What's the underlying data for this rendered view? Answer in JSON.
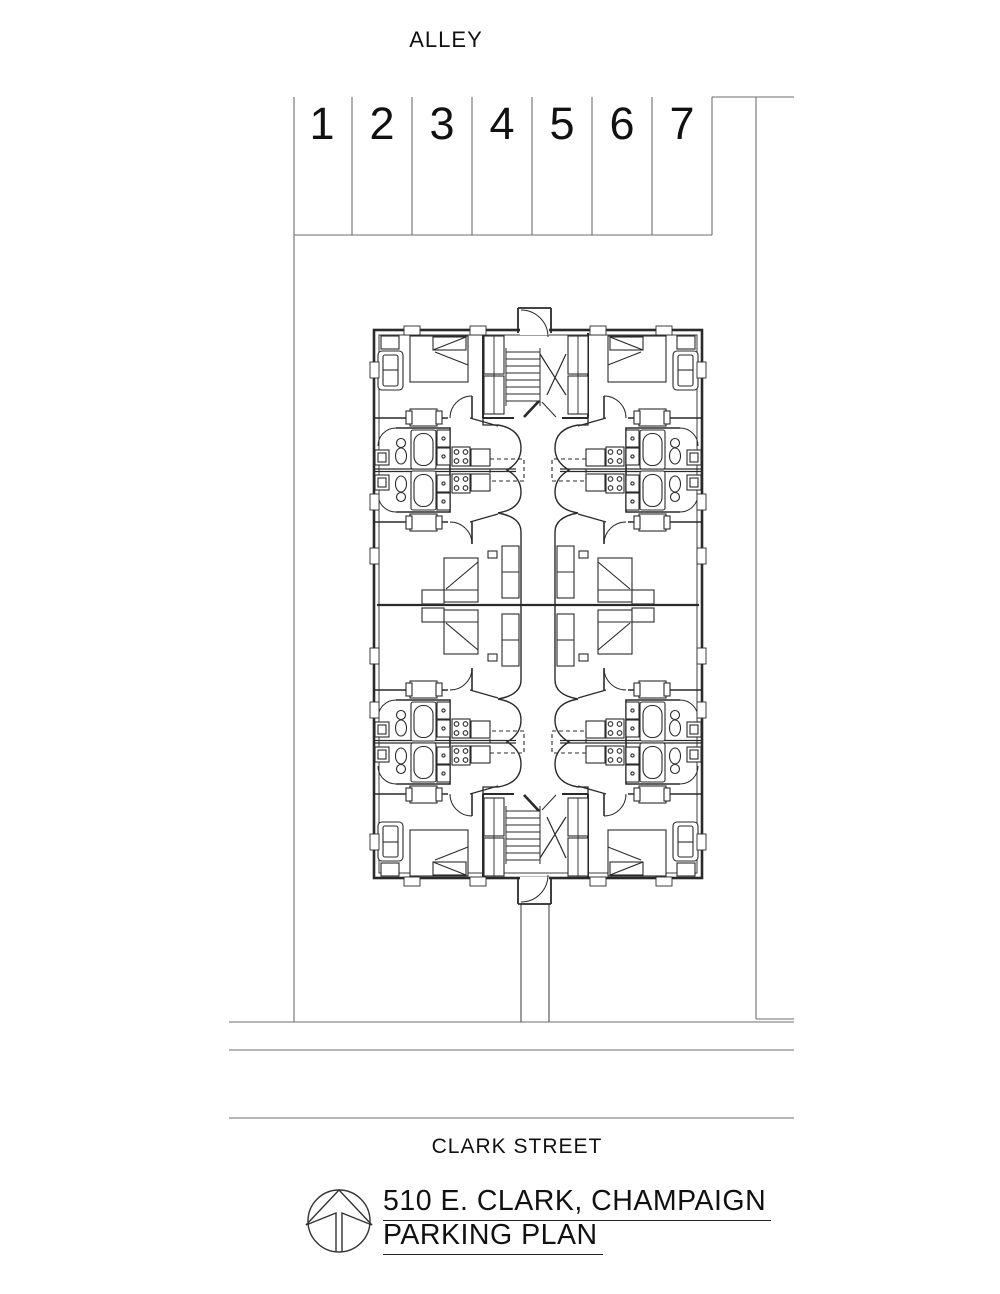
{
  "labels": {
    "alley": "ALLEY",
    "street": "CLARK STREET"
  },
  "parking": {
    "stalls": [
      "1",
      "2",
      "3",
      "4",
      "5",
      "6",
      "7"
    ]
  },
  "title_block": {
    "line1": "510 E. CLARK, CHAMPAIGN",
    "line2": "PARKING PLAN"
  },
  "drawing": {
    "building": "4-unit apartment floor plan with central stair cores and corridor",
    "site_features": [
      "alley at top",
      "7 parking stalls",
      "walkway to street",
      "Clark Street at bottom"
    ]
  },
  "colors": {
    "drawing_line": "#2a2a2a",
    "site_line": "#6e6e6e",
    "text": "#111111",
    "background": "#ffffff"
  }
}
